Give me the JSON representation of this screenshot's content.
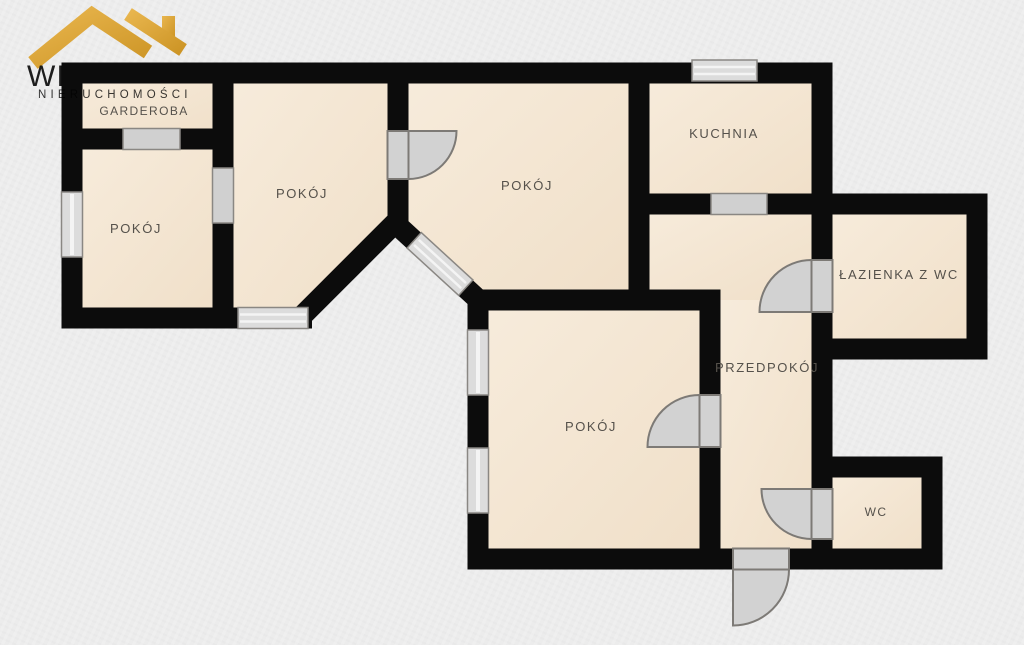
{
  "brand": {
    "name_visible": "WI",
    "tagline": "NIERUCHOMOŚCI",
    "roof_icon": "gold-roof-icon",
    "accent_gold": "#d9a437"
  },
  "plan": {
    "type": "apartment-floor-plan",
    "rooms": [
      {
        "id": "garderoba",
        "label": "GARDEROBA"
      },
      {
        "id": "pokoj-1",
        "label": "POKÓJ"
      },
      {
        "id": "pokoj-2",
        "label": "POKÓJ"
      },
      {
        "id": "pokoj-3",
        "label": "POKÓJ"
      },
      {
        "id": "kuchnia",
        "label": "KUCHNIA"
      },
      {
        "id": "lazienka",
        "label": "ŁAZIENKA Z WC"
      },
      {
        "id": "przedpokoj",
        "label": "PRZEDPOKÓJ"
      },
      {
        "id": "pokoj-4",
        "label": "POKÓJ"
      },
      {
        "id": "wc",
        "label": "WC"
      }
    ],
    "features": {
      "windows": 6,
      "swing_doors": 5,
      "passage_openings": 3
    }
  },
  "colors": {
    "background": "#ececec",
    "wall": "#0c0c0c",
    "floor": "#f3e7d6",
    "fixture_gray": "#d2d2d2",
    "label_text": "#55514b"
  }
}
